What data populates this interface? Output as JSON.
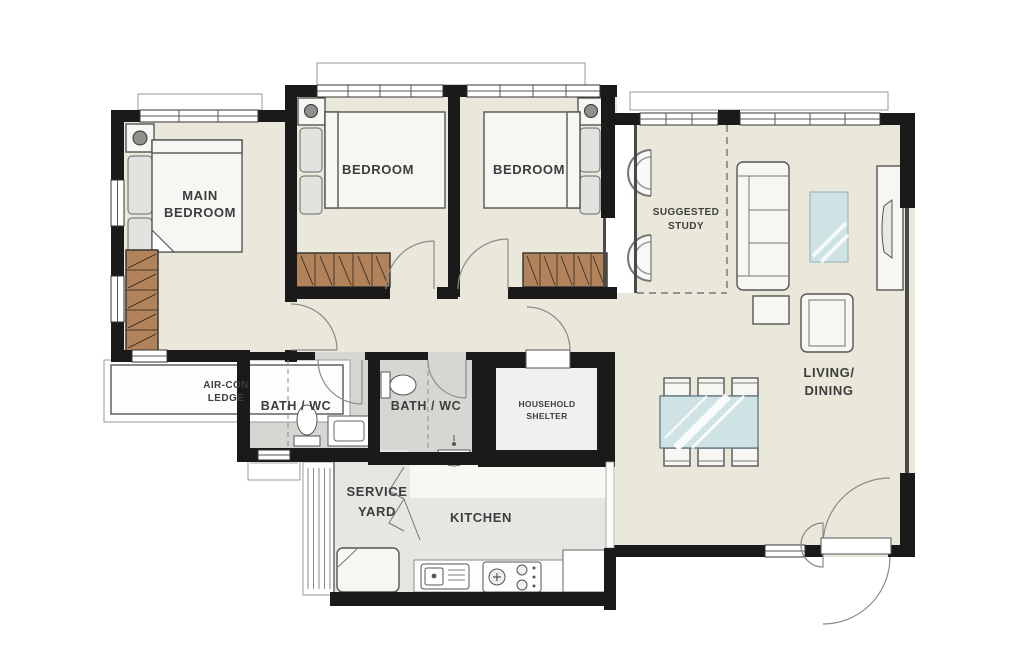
{
  "plan": {
    "type": "apartment-floor-plan",
    "colors": {
      "wall": "#1a1a1a",
      "floor_cream": "#eae8db",
      "floor_wet": "#d7d6d3",
      "floor_utility": "#e6e6e3",
      "furniture_fill": "#f6f6f3",
      "wardrobe": "#b2835a",
      "wardrobe_line": "#4a3a28",
      "glass_blue": "#cfe2e4",
      "label_text": "#3d3d3d"
    },
    "rooms": {
      "main_bedroom": {
        "label_lines": [
          "MAIN",
          "BEDROOM"
        ]
      },
      "bedroom_2": {
        "label": "BEDROOM"
      },
      "bedroom_3": {
        "label": "BEDROOM"
      },
      "suggested_study": {
        "label_lines": [
          "SUGGESTED",
          "STUDY"
        ]
      },
      "living_dining": {
        "label_lines": [
          "LIVING/",
          "DINING"
        ]
      },
      "air_con_ledge": {
        "label_lines": [
          "AIR-CON",
          "LEDGE"
        ]
      },
      "bath_1": {
        "label": "BATH / WC"
      },
      "bath_2": {
        "label": "BATH / WC"
      },
      "household_shelter": {
        "label_lines": [
          "HOUSEHOLD",
          "SHELTER"
        ]
      },
      "service_yard": {
        "label_lines": [
          "SERVICE",
          "YARD"
        ]
      },
      "kitchen": {
        "label": "KITCHEN"
      }
    },
    "furniture_icons": [
      "bed",
      "wardrobe",
      "bedside-lamp",
      "dresser",
      "sofa",
      "armchair",
      "side-table",
      "rug",
      "tv-console",
      "dining-table",
      "dining-chair",
      "study-chair",
      "toilet",
      "vanity-sink",
      "basin",
      "washing-machine",
      "laundry-rack",
      "kitchen-sink",
      "cooktop",
      "fridge",
      "door-swing",
      "window"
    ]
  }
}
